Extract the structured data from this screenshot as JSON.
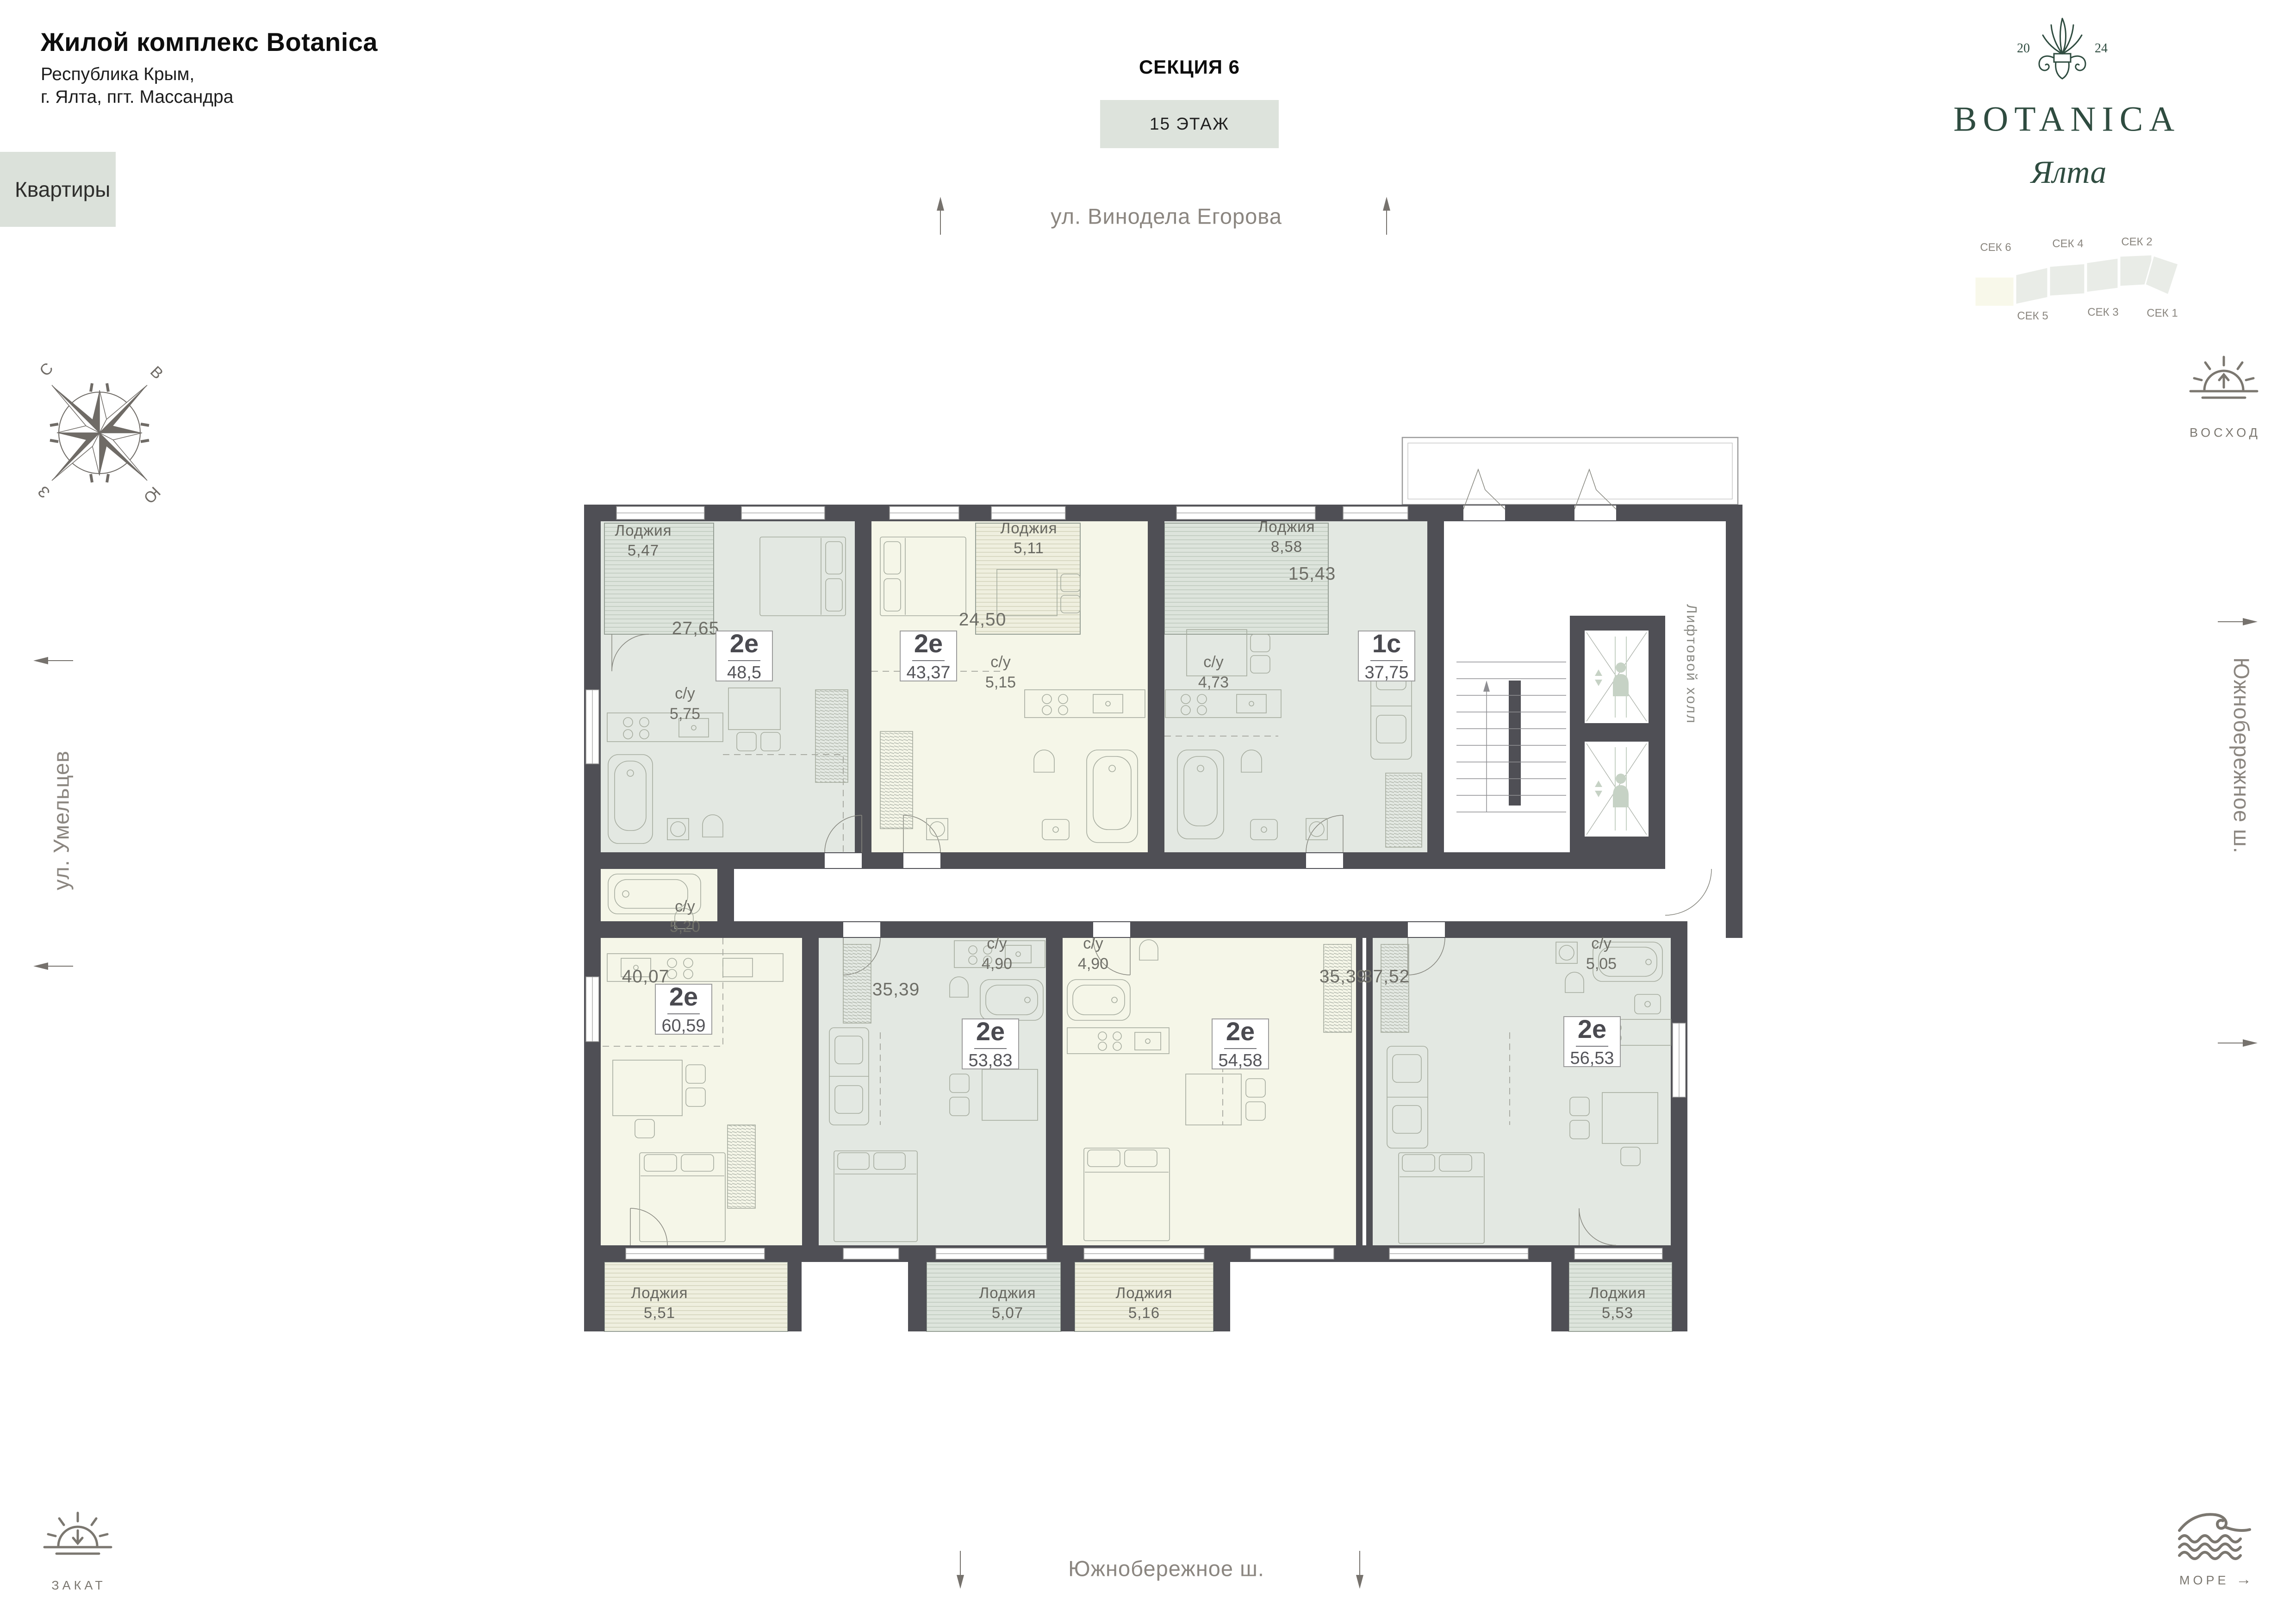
{
  "palette": {
    "wall": "#4f4f55",
    "sage": "#e3e8e2",
    "cream": "#f5f6e8",
    "loggia_sage": "#dde4dc",
    "loggia_cream": "#efefdf",
    "brand_green": "#2f4c40",
    "accent_box": "#dde3dc",
    "street_text": "#8b8680"
  },
  "header": {
    "title": "Жилой комплекс Botanica",
    "subtitle1": "Республика Крым,",
    "subtitle2": "г. Ялта, пгт. Массандра",
    "apartments_label": "Квартиры",
    "section_title": "СЕКЦИЯ 6",
    "floor_label": "15 ЭТАЖ"
  },
  "logo": {
    "year_left": "20",
    "year_right": "24",
    "brand": "BOTANICA",
    "city": "Ялта"
  },
  "section_map": {
    "sec6": "СЕК 6",
    "sec5": "СЕК 5",
    "sec4": "СЕК 4",
    "sec3": "СЕК 3",
    "sec2": "СЕК 2",
    "sec1": "СЕК 1"
  },
  "compass": {
    "n": "С",
    "e": "В",
    "s": "Ю",
    "w": "З"
  },
  "streets": {
    "top": "ул. Винодела Егорова",
    "left": "ул. Умельцев",
    "right": "Южнобережное ш.",
    "bottom": "Южнобережное ш."
  },
  "landmarks": {
    "sunrise": "ВОСХОД",
    "sunset": "ЗАКАТ",
    "sea": "МОРЕ",
    "sea_arrow": "→"
  },
  "plan": {
    "elevator_hall": "Лифтовой холл",
    "apartments": [
      {
        "type": "2е",
        "area": "48,5",
        "living": "27,65",
        "wc_label": "с/у",
        "wc": "5,75",
        "loggia_label": "Лоджия",
        "loggia": "5,47"
      },
      {
        "type": "2е",
        "area": "43,37",
        "living": "24,50",
        "wc_label": "с/у",
        "wc": "5,15",
        "loggia_label": "Лоджия",
        "loggia": "5,11"
      },
      {
        "type": "1с",
        "area": "37,75",
        "living": "15,43",
        "wc_label": "с/у",
        "wc": "4,73",
        "loggia_label": "Лоджия",
        "loggia": "8,58"
      },
      {
        "type": "2е",
        "area": "60,59",
        "living": "40,07",
        "wc_label": "с/у",
        "wc": "5,20",
        "loggia_label": "Лоджия",
        "loggia": "5,51"
      },
      {
        "type": "2е",
        "area": "53,83",
        "living": "35,39",
        "wc_label": "с/у",
        "wc": "4,90",
        "loggia_label": "Лоджия",
        "loggia": "5,07"
      },
      {
        "type": "2е",
        "area": "54,58",
        "living": "35,39",
        "wc_label": "с/у",
        "wc": "4,90",
        "loggia_label": "Лоджия",
        "loggia": "5,16"
      },
      {
        "type": "2е",
        "area": "56,53",
        "living": "37,52",
        "wc_label": "с/у",
        "wc": "5,05",
        "loggia_label": "Лоджия",
        "loggia": "5,53"
      }
    ]
  }
}
